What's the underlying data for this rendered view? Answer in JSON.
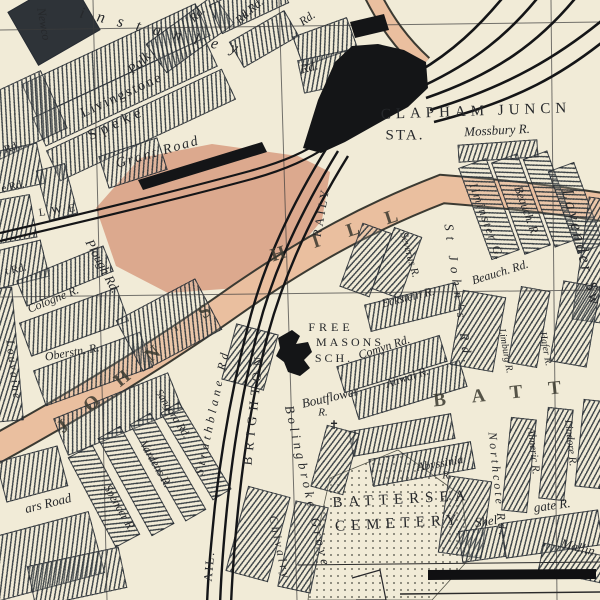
{
  "map": {
    "title": "Clapham Junction / Battersea street map",
    "colors": {
      "paper": "#f1ebd7",
      "road": "#eabf9f",
      "field": "#dca98e",
      "rail": "#141517",
      "ink": "#26282b"
    },
    "station": {
      "name": "CLAPHAM JUNCN",
      "abbr": "STA."
    },
    "labels": [
      {
        "name": "label-winstanley-road",
        "text": "instanley",
        "x": 165,
        "y": 33,
        "rot": 13,
        "size": 16,
        "ls": 13,
        "cls": "it"
      },
      {
        "name": "label-rd-fragment-1",
        "text": "Rd.",
        "x": 197,
        "y": 14,
        "rot": -45,
        "size": 12,
        "cls": "it"
      },
      {
        "name": "label-rd-fragment-2",
        "text": "Rd.",
        "x": 243,
        "y": 16,
        "rot": -45,
        "size": 12,
        "cls": "it"
      },
      {
        "name": "label-rd-fragment-3",
        "text": "k Rd.",
        "x": 252,
        "y": 8,
        "rot": -40,
        "size": 12,
        "cls": "it"
      },
      {
        "name": "label-rd-fragment-4",
        "text": "Rd.",
        "x": 307,
        "y": 18,
        "rot": -35,
        "size": 12,
        "cls": "it"
      },
      {
        "name": "label-rd-fragment-5",
        "text": "Rd.",
        "x": 309,
        "y": 67,
        "rot": -15,
        "size": 13,
        "cls": "it"
      },
      {
        "name": "label-newcomen-road",
        "text": "Newco",
        "x": 44,
        "y": 24,
        "rot": 80,
        "size": 12,
        "cls": "it"
      },
      {
        "name": "label-livingstone-road",
        "text": "Livingstone",
        "x": 122,
        "y": 96,
        "rot": -25,
        "size": 14,
        "ls": 2
      },
      {
        "name": "label-speke-road",
        "text": "Speke",
        "x": 117,
        "y": 124,
        "rot": -25,
        "size": 15,
        "ls": 5
      },
      {
        "name": "label-grant-road",
        "text": "Grant Road",
        "x": 158,
        "y": 153,
        "rot": -16,
        "size": 14,
        "ls": 2,
        "cls": "it"
      },
      {
        "name": "label-palk-road",
        "text": "Palk",
        "x": 140,
        "y": 64,
        "rot": -42,
        "size": 14,
        "cls": "it"
      },
      {
        "name": "label-rd-left-1",
        "text": "Rd.",
        "x": 12,
        "y": 148,
        "rot": -20,
        "size": 11
      },
      {
        "name": "label-rd-left-2",
        "text": "e Rd.",
        "x": 13,
        "y": 187,
        "rot": -12,
        "size": 11
      },
      {
        "name": "label-rd-left-3",
        "text": "t Rd.",
        "x": 16,
        "y": 270,
        "rot": -12,
        "size": 11
      },
      {
        "name": "label-lwe-boundary",
        "text": "L W E",
        "x": 58,
        "y": 211,
        "rot": -8,
        "size": 11,
        "cls": "caps"
      },
      {
        "name": "label-plough-road",
        "text": "Plough Rd.",
        "x": 103,
        "y": 266,
        "rot": 62,
        "size": 13,
        "cls": "it"
      },
      {
        "name": "label-cologne-road",
        "text": "Cologne R.",
        "x": 53,
        "y": 299,
        "rot": -22,
        "size": 12,
        "cls": "it"
      },
      {
        "name": "label-oberstein-road",
        "text": "Oberstn. R.",
        "x": 72,
        "y": 352,
        "rot": -10,
        "size": 12,
        "cls": "it"
      },
      {
        "name": "label-louvaine-road",
        "text": "Louvaine",
        "x": 14,
        "y": 370,
        "rot": 83,
        "size": 12,
        "ls": 2,
        "cls": "it"
      },
      {
        "name": "label-st-johns-hill-1",
        "text": "J O H N ' S",
        "x": 138,
        "y": 366,
        "rot": -39,
        "size": 19,
        "ls": 10,
        "cls": "road"
      },
      {
        "name": "label-st-johns-hill-2",
        "text": "H I L L",
        "x": 340,
        "y": 234,
        "rot": -18,
        "size": 19,
        "ls": 12,
        "cls": "road"
      },
      {
        "name": "label-sangora-road",
        "text": "Sangora Rd.",
        "x": 172,
        "y": 414,
        "rot": 58,
        "size": 11,
        "cls": "it"
      },
      {
        "name": "label-vardens-road",
        "text": "Vardens R.",
        "x": 156,
        "y": 464,
        "rot": 60,
        "size": 12,
        "cls": "it"
      },
      {
        "name": "label-strathblane-road",
        "text": "Strathblane Rd",
        "x": 212,
        "y": 412,
        "rot": -78,
        "size": 12,
        "ls": 4,
        "cls": "it"
      },
      {
        "name": "label-spencer-road",
        "text": "Spencer R.",
        "x": 120,
        "y": 508,
        "rot": 60,
        "size": 12,
        "cls": "it"
      },
      {
        "name": "label-ars-road",
        "text": "ars Road",
        "x": 48,
        "y": 503,
        "rot": -14,
        "size": 13,
        "cls": "it"
      },
      {
        "name": "label-railway",
        "text": "RAILY",
        "x": 321,
        "y": 212,
        "rot": -80,
        "size": 12,
        "ls": 3,
        "cls": "caps"
      },
      {
        "name": "label-brighton-railway",
        "text": "BRIGHTON",
        "x": 253,
        "y": 408,
        "rot": -84,
        "size": 13,
        "ls": 6,
        "cls": "caps"
      },
      {
        "name": "label-rail-bottom",
        "text": "AIL.",
        "x": 209,
        "y": 566,
        "rot": -85,
        "size": 12,
        "ls": 2,
        "cls": "caps"
      },
      {
        "name": "label-freemasons-1",
        "text": "FREE",
        "x": 331,
        "y": 327,
        "rot": 0,
        "size": 12,
        "ls": 4,
        "cls": "caps"
      },
      {
        "name": "label-freemasons-2",
        "text": "MASONS",
        "x": 350,
        "y": 342,
        "rot": 0,
        "size": 12,
        "ls": 3,
        "cls": "caps"
      },
      {
        "name": "label-freemasons-3",
        "text": "SCH.",
        "x": 334,
        "y": 358,
        "rot": 0,
        "size": 12,
        "ls": 3,
        "cls": "caps"
      },
      {
        "name": "label-boutflower-road",
        "text": "Boutflower",
        "x": 330,
        "y": 397,
        "rot": -13,
        "size": 13,
        "cls": "it"
      },
      {
        "name": "label-boutflower-r",
        "text": "R.",
        "x": 323,
        "y": 413,
        "rot": 0,
        "size": 11,
        "cls": "it"
      },
      {
        "name": "label-church-cross",
        "text": "✝",
        "x": 334,
        "y": 425,
        "rot": 0,
        "size": 12,
        "cls": "sym"
      },
      {
        "name": "label-comyn-road",
        "text": "Comyn Rd.",
        "x": 384,
        "y": 347,
        "rot": -18,
        "size": 12,
        "cls": "it"
      },
      {
        "name": "label-aliwal-road",
        "text": "Aliwal R.",
        "x": 407,
        "y": 377,
        "rot": -18,
        "size": 12,
        "cls": "it"
      },
      {
        "name": "label-eckstein-road",
        "text": "Eckstein R.",
        "x": 408,
        "y": 297,
        "rot": -14,
        "size": 12,
        "cls": "it"
      },
      {
        "name": "label-severus-road",
        "text": "Severus R.",
        "x": 409,
        "y": 255,
        "rot": 74,
        "size": 11,
        "cls": "it"
      },
      {
        "name": "label-st-johns-road",
        "text": "St John's Rd.",
        "x": 459,
        "y": 296,
        "rot": 82,
        "size": 13,
        "ls": 6,
        "cls": "it"
      },
      {
        "name": "label-ilminster-gardens",
        "text": "Ilminster G.",
        "x": 487,
        "y": 222,
        "rot": 70,
        "size": 12,
        "ls": 2,
        "cls": "it"
      },
      {
        "name": "label-beauchamp-road-v",
        "text": "Beauch. R.",
        "x": 527,
        "y": 211,
        "rot": 70,
        "size": 12,
        "cls": "it"
      },
      {
        "name": "label-beauchamp-road",
        "text": "Beauch. Rd.",
        "x": 500,
        "y": 272,
        "rot": -17,
        "size": 12,
        "cls": "it"
      },
      {
        "name": "label-lavender-sweep",
        "text": "Lavender Sw",
        "x": 582,
        "y": 248,
        "rot": 76,
        "size": 17,
        "ls": 3,
        "cls": "it"
      },
      {
        "name": "label-limburg-road",
        "text": "Limburg R.",
        "x": 505,
        "y": 351,
        "rot": 80,
        "size": 10,
        "cls": "it"
      },
      {
        "name": "label-hafer-road",
        "text": "Hafer R.",
        "x": 545,
        "y": 349,
        "rot": 80,
        "size": 10,
        "cls": "it"
      },
      {
        "name": "label-mossbury-road",
        "text": "Mossbury R.",
        "x": 497,
        "y": 130,
        "rot": -3,
        "size": 13,
        "cls": "it"
      },
      {
        "name": "label-clapham-junction",
        "text": "CLAPHAM JUNCN",
        "x": 476,
        "y": 112,
        "rot": -2,
        "size": 15,
        "ls": 5,
        "cls": "caps"
      },
      {
        "name": "label-station",
        "text": "STA.",
        "x": 405,
        "y": 136,
        "rot": 0,
        "size": 15,
        "ls": 2,
        "cls": "caps"
      },
      {
        "name": "label-battersea-district",
        "text": "BATT",
        "x": 510,
        "y": 393,
        "rot": -6,
        "size": 19,
        "ls": 26,
        "cls": "road"
      },
      {
        "name": "label-cemetery-1",
        "text": "BATTERSEA",
        "x": 402,
        "y": 500,
        "rot": -3,
        "size": 15,
        "ls": 6,
        "cls": "caps"
      },
      {
        "name": "label-cemetery-2",
        "text": "CEMETERY",
        "x": 399,
        "y": 524,
        "rot": -3,
        "size": 15,
        "ls": 6,
        "cls": "caps"
      },
      {
        "name": "label-abyssinia-road",
        "text": "Abyssinia",
        "x": 440,
        "y": 463,
        "rot": -10,
        "size": 12,
        "cls": "it"
      },
      {
        "name": "label-abyssinia-r",
        "text": "R.",
        "x": 447,
        "y": 476,
        "rot": 0,
        "size": 11,
        "cls": "it"
      },
      {
        "name": "label-shelgate-1",
        "text": "Shel",
        "x": 486,
        "y": 521,
        "rot": -8,
        "size": 13,
        "cls": "it"
      },
      {
        "name": "label-shelgate-2",
        "text": "gate R.",
        "x": 552,
        "y": 505,
        "rot": -8,
        "size": 13,
        "cls": "it"
      },
      {
        "name": "label-northcote-road",
        "text": "Northcote Rd.",
        "x": 498,
        "y": 485,
        "rot": 84,
        "size": 12,
        "ls": 3,
        "cls": "it"
      },
      {
        "name": "label-almeric-road",
        "text": "Almeric R.",
        "x": 533,
        "y": 451,
        "rot": 84,
        "size": 11,
        "cls": "it"
      },
      {
        "name": "label-lindore-road",
        "text": "Lindore R.",
        "x": 570,
        "y": 443,
        "rot": 84,
        "size": 11,
        "cls": "it"
      },
      {
        "name": "label-mallinson-road",
        "text": "Mallin",
        "x": 578,
        "y": 547,
        "rot": 14,
        "size": 13,
        "cls": "it"
      },
      {
        "name": "label-chivalry-road",
        "text": "Chivalry",
        "x": 280,
        "y": 548,
        "rot": 78,
        "size": 12,
        "ls": 3,
        "cls": "it"
      },
      {
        "name": "label-bolingbroke-grove",
        "text": "Bolingbroke Grove",
        "x": 308,
        "y": 487,
        "rot": 77,
        "size": 13,
        "ls": 4,
        "cls": "it"
      }
    ]
  }
}
